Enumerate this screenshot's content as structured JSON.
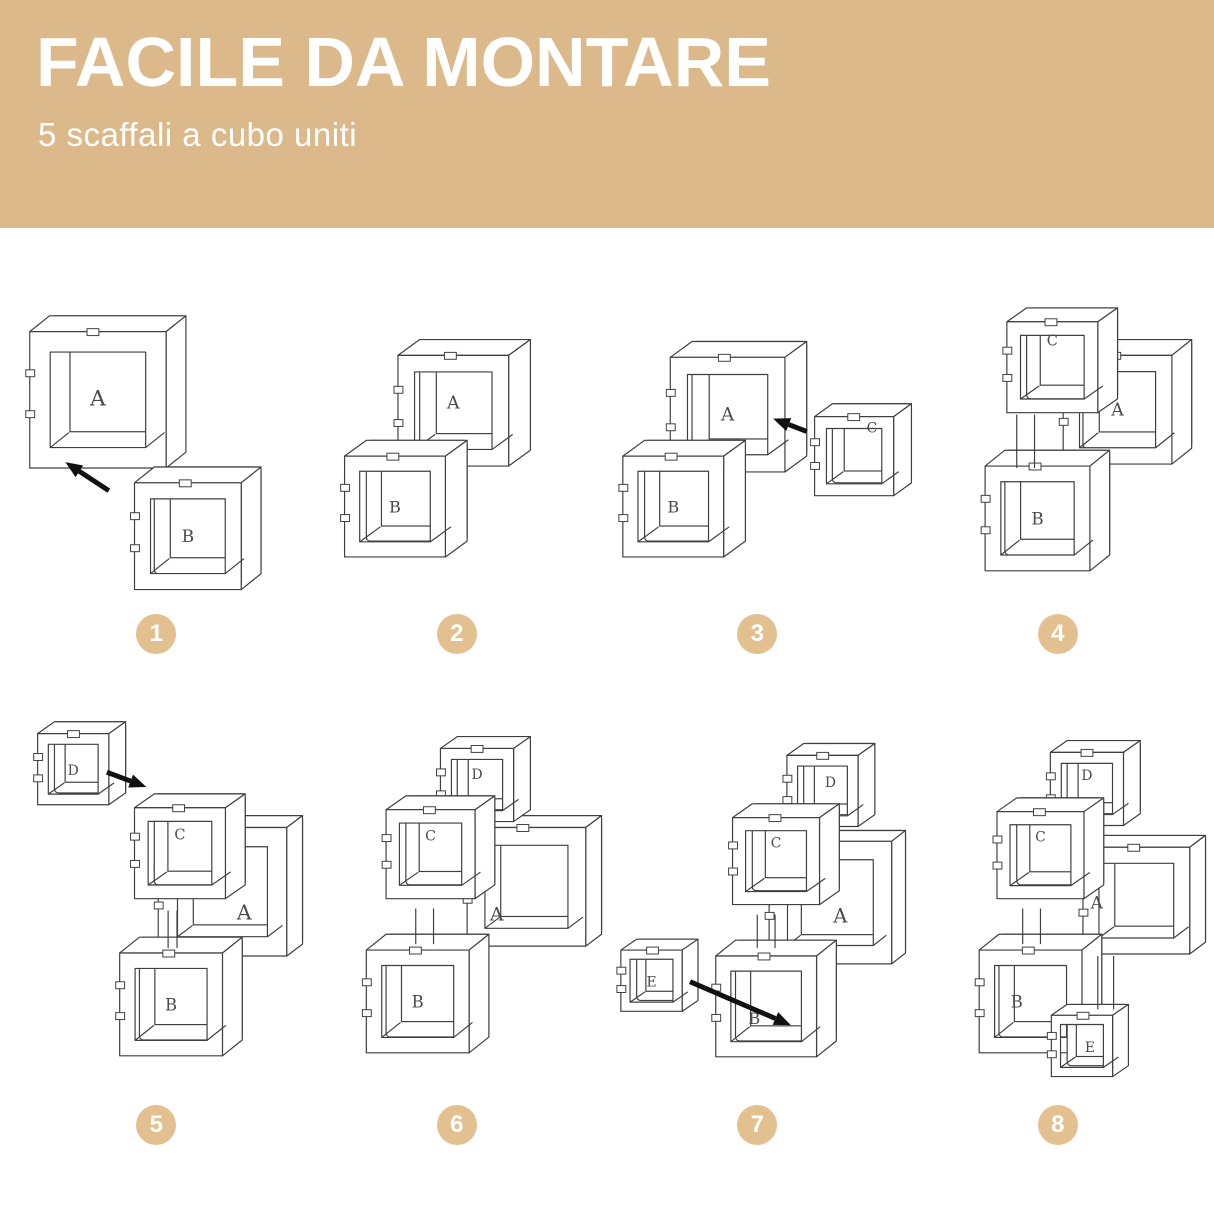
{
  "banner": {
    "title": "FACILE DA MONTARE",
    "subtitle": "5 scaffali a cubo uniti",
    "bg_color": "#dcb98b",
    "text_color": "#ffffff"
  },
  "diagram": {
    "stroke_color": "#3f3f3f",
    "label_color": "#4a4a4a",
    "arrow_color": "#111111",
    "badge_bg": "#e2c08f",
    "badge_text_color": "#ffffff",
    "steps": [
      {
        "number": "1",
        "view": {
          "w": 300,
          "h": 310
        },
        "cubes": [
          {
            "label": "A",
            "x": 22,
            "y": 32,
            "s": 138,
            "dx": 20,
            "dy": -16
          },
          {
            "label": "B",
            "x": 128,
            "y": 185,
            "s": 108,
            "dx": 20,
            "dy": -16
          }
        ],
        "arrows": [
          {
            "x1": 102,
            "y1": 193,
            "x2": 58,
            "y2": 164
          }
        ],
        "links": []
      },
      {
        "number": "2",
        "view": {
          "w": 300,
          "h": 310
        },
        "cubes": [
          {
            "label": "A",
            "x": 90,
            "y": 56,
            "s": 112,
            "dx": 22,
            "dy": -16,
            "ly": -8
          },
          {
            "label": "B",
            "x": 36,
            "y": 158,
            "s": 102,
            "dx": 22,
            "dy": -16
          }
        ],
        "arrows": [],
        "links": []
      },
      {
        "number": "3",
        "view": {
          "w": 300,
          "h": 310
        },
        "cubes": [
          {
            "label": "A",
            "x": 62,
            "y": 58,
            "s": 116,
            "dx": 22,
            "dy": -16
          },
          {
            "label": "B",
            "x": 14,
            "y": 158,
            "s": 102,
            "dx": 22,
            "dy": -16
          },
          {
            "label": "C",
            "x": 208,
            "y": 118,
            "s": 80,
            "dx": 18,
            "dy": -13,
            "lx": 18,
            "ly": -30
          }
        ],
        "arrows": [
          {
            "x1": 200,
            "y1": 133,
            "x2": 166,
            "y2": 120
          }
        ],
        "links": []
      },
      {
        "number": "4",
        "view": {
          "w": 300,
          "h": 310
        },
        "cubes": [
          {
            "label": "A",
            "x": 155,
            "y": 56,
            "s": 110,
            "dx": 20,
            "dy": -16
          },
          {
            "label": "C",
            "x": 98,
            "y": 22,
            "s": 92,
            "dx": 20,
            "dy": -14,
            "ly": -28
          },
          {
            "label": "B",
            "x": 76,
            "y": 168,
            "s": 106,
            "dx": 20,
            "dy": -16
          }
        ],
        "arrows": [],
        "links": [
          {
            "x": 108,
            "y1": 116,
            "y2": 170,
            "g": 18
          }
        ]
      },
      {
        "number": "5",
        "view": {
          "w": 300,
          "h": 400
        },
        "cubes": [
          {
            "label": "A",
            "x": 152,
            "y": 128,
            "s": 130,
            "dx": 16,
            "dy": -12,
            "lx": 22,
            "ly": 22
          },
          {
            "label": "C",
            "x": 128,
            "y": 108,
            "s": 92,
            "dx": 20,
            "dy": -14,
            "ly": -20
          },
          {
            "label": "B",
            "x": 113,
            "y": 255,
            "s": 104,
            "dx": 20,
            "dy": -16
          },
          {
            "label": "D",
            "x": 30,
            "y": 33,
            "s": 72,
            "dx": 17,
            "dy": -12
          }
        ],
        "arrows": [
          {
            "x1": 100,
            "y1": 72,
            "x2": 140,
            "y2": 87
          }
        ],
        "links": [
          {
            "x": 162,
            "y1": 212,
            "y2": 250,
            "g": 9
          }
        ]
      },
      {
        "number": "6",
        "view": {
          "w": 300,
          "h": 400
        },
        "cubes": [
          {
            "label": "A",
            "x": 160,
            "y": 128,
            "s": 120,
            "dx": 16,
            "dy": -12,
            "lx": -30,
            "ly": 28
          },
          {
            "label": "D",
            "x": 133,
            "y": 48,
            "s": 74,
            "dx": 17,
            "dy": -12,
            "ly": -12
          },
          {
            "label": "C",
            "x": 78,
            "y": 110,
            "s": 90,
            "dx": 20,
            "dy": -14,
            "ly": -20
          },
          {
            "label": "B",
            "x": 58,
            "y": 252,
            "s": 104,
            "dx": 20,
            "dy": -16
          }
        ],
        "arrows": [],
        "links": [
          {
            "x": 108,
            "y1": 210,
            "y2": 246,
            "g": 18
          }
        ]
      },
      {
        "number": "7",
        "view": {
          "w": 300,
          "h": 400
        },
        "cubes": [
          {
            "label": "A",
            "x": 162,
            "y": 142,
            "s": 124,
            "dx": 14,
            "dy": -11,
            "lx": 10,
            "ly": 14
          },
          {
            "label": "D",
            "x": 180,
            "y": 55,
            "s": 72,
            "dx": 17,
            "dy": -12,
            "lx": 8,
            "ly": -10
          },
          {
            "label": "C",
            "x": 125,
            "y": 118,
            "s": 88,
            "dx": 20,
            "dy": -14,
            "ly": -20
          },
          {
            "label": "B",
            "x": 108,
            "y": 258,
            "s": 102,
            "dx": 20,
            "dy": -16,
            "lx": -12,
            "ly": 12
          },
          {
            "label": "E",
            "x": 12,
            "y": 252,
            "s": 62,
            "dx": 16,
            "dy": -11
          }
        ],
        "arrows": [
          {
            "x1": 82,
            "y1": 284,
            "x2": 184,
            "y2": 328
          }
        ],
        "links": [
          {
            "x": 150,
            "y1": 216,
            "y2": 250,
            "g": 18
          }
        ]
      },
      {
        "number": "8",
        "view": {
          "w": 300,
          "h": 400
        },
        "cubes": [
          {
            "label": "A",
            "x": 175,
            "y": 148,
            "s": 108,
            "dx": 16,
            "dy": -12,
            "lx": -40,
            "ly": 2
          },
          {
            "label": "D",
            "x": 142,
            "y": 52,
            "s": 74,
            "dx": 17,
            "dy": -12,
            "ly": -15
          },
          {
            "label": "C",
            "x": 88,
            "y": 112,
            "s": 88,
            "dx": 20,
            "dy": -14,
            "ly": -20
          },
          {
            "label": "B",
            "x": 70,
            "y": 252,
            "s": 104,
            "dx": 20,
            "dy": -16,
            "lx": -14
          },
          {
            "label": "E",
            "x": 143,
            "y": 318,
            "s": 62,
            "dx": 16,
            "dy": -11,
            "lx": 8
          }
        ],
        "arrows": [],
        "links": [
          {
            "x": 114,
            "y1": 210,
            "y2": 246,
            "g": 18
          },
          {
            "x": 190,
            "y1": 258,
            "y2": 312,
            "g": 16
          }
        ]
      }
    ]
  }
}
